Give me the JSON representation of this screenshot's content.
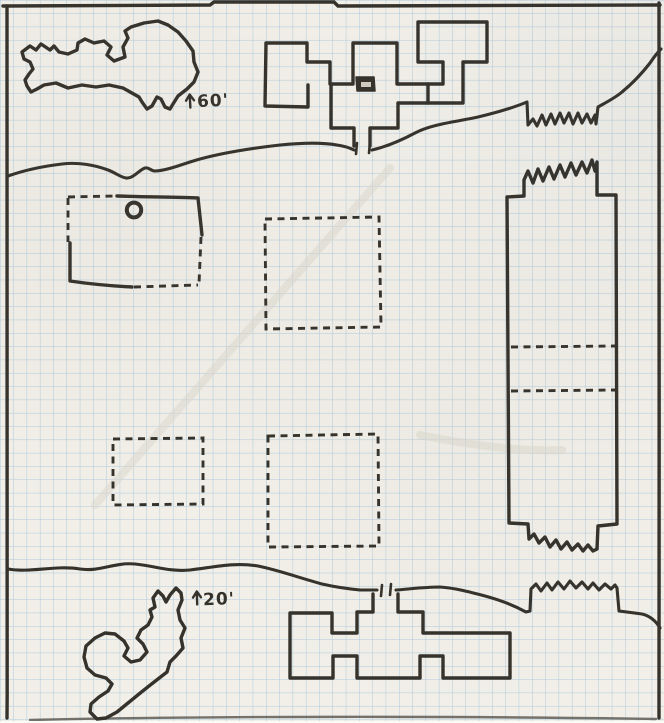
{
  "palette": {
    "paper": "#f1efe8",
    "grid": "#a3c3da",
    "ink": "#35322c",
    "ink-soft": "#55524b",
    "crease": "#dcd8cd"
  },
  "grid": {
    "cell_px": 13.3
  },
  "annotations": {
    "upper": {
      "label": "60'",
      "arrow_d": "M 190,107 L 190,95 M 186,100 L 190,94 L 194,100"
    },
    "lower": {
      "label": "20'",
      "arrow_d": "M 197,604 L 197,592 M 193,597 L 197,591 L 201,597"
    }
  },
  "features": {
    "border_top": {
      "d": "M 3,6 L 210,5 L 214,2 L 334,2 L 338,6 L 660,5"
    },
    "border_left": {
      "d": "M 7,6 C 6,200 9,460 7,718"
    },
    "border_right": {
      "d": "M 659,3 C 661,240 658,480 659,718"
    },
    "border_bottom": {
      "d": "M 30,720 C 200,716 460,716 656,719"
    },
    "cave_northwest": {
      "d": "M 22,52 L 30,46 L 36,50 L 41,44 L 50,50 L 54,46 L 59,52 L 68,54 L 77,50 L 78,43 L 85,39 L 94,43 L 104,41 L 111,47 L 107,55 L 114,61 L 125,57 L 123,47 L 128,38 L 125,31 L 131,27 L 144,23 L 158,21 L 168,25 L 178,32 L 186,41 L 193,51 L 194,62 L 198,72 L 194,82 L 187,89 L 178,96 L 173,104 L 170,109 L 165,107 L 161,99 L 157,97 L 152,106 L 147,109 L 142,102 L 139,97 L 123,88 L 109,85 L 96,87 L 82,85 L 68,88 L 56,83 L 44,85 L 37,89 L 31,92 L 27,86 L 25,80 L 29,74 L 33,69 L 30,62 L 24,59 Z"
    },
    "north_complex_west": {
      "d": "M 266,43 L 307,43 L 307,62 L 330,62 L 330,84 L 353,84 L 353,43 L 397,43 L 397,84 L 428,84 L 428,103 L 398,103 L 398,128 L 370,128 L 370,146 M 266,43 L 265,106 L 308,107 L 308,85 M 331,84 L 331,128 L 354,128 L 354,146"
    },
    "north_complex_east": {
      "d": "M 418,22 L 487,22 L 487,62 L 463,62 L 463,103 L 428,103 M 418,22 L 418,62 L 443,62 L 443,84 L 428,84"
    },
    "north_door_block": {
      "d": "M 356,77 L 374,77 L 375,91 L 357,91 Z"
    },
    "north_door_slot": {
      "d": "M 361,82 L 371,82 L 371,87 L 361,87 Z"
    },
    "north_door_ticks": {
      "d": "M 357,143 L 356,154 M 370,142 L 369,153"
    },
    "cliff_upper": {
      "d": "M 8,176 C 25,170 45,166 62,164 C 78,162 95,165 108,170 C 116,173 120,177 126,178 C 133,179 139,170 145,168 C 149,167 151,171 155,171 C 163,171 175,167 190,162 C 215,154 245,149 280,145 C 300,143 320,142 337,145 C 344,146 350,148 354,150 M 372,150 C 385,147 400,141 415,133 C 432,124 455,122 478,117 C 495,113 515,107 527,102 L 528,125 L 533,119 L 537,126 L 542,115 L 546,125 L 551,114 L 555,124 L 560,113 L 564,123 L 569,113 L 573,124 L 578,113 L 582,123 L 587,114 L 591,123 L 595,115 L 596,124 L 598,107 C 605,103 615,98 622,92 C 633,83 643,72 650,63 C 654,57 658,52 661,49"
    },
    "west_room_solid": {
      "d": "M 117,196 C 145,197 175,197 198,198 L 202,235 M 70,243 L 70,281 C 90,284 112,286 132,287"
    },
    "west_room_dashed": {
      "d": "M 68,197 L 115,196 M 68,198 L 68,242 M 134,287 L 198,285 M 201,237 L 199,284"
    },
    "west_room_pillar": {
      "d": "M 126.8,210 a 7.2,7.4 0 1 0 14.4,0 a 7.2,7.4 0 1 0 -14.4,0"
    },
    "pit_upper_middle": {
      "d": "M 265,219 L 379,217 L 381,327 L 266,329 Z"
    },
    "pit_lower_left": {
      "d": "M 113,439 L 203,438 L 203,504 L 113,505 Z"
    },
    "pit_lower_middle": {
      "d": "M 268,436 L 378,434 L 379,546 L 268,547 Z"
    },
    "east_hall": {
      "d": "M 507,197 L 524,196 L 524,180 L 528,171 L 533,183 L 538,169 L 543,181 L 549,167 L 554,179 L 560,165 L 565,177 L 571,163 L 576,175 L 582,162 L 587,173 L 592,160 L 595,171 L 597,162 L 597,195 L 616,195 L 617,524 L 598,526 L 597,549 L 593,551 L 588,545 L 583,551 L 578,544 L 572,550 L 567,542 L 561,549 L 556,540 L 550,547 L 545,537 L 539,543 L 534,534 L 529,539 L 528,524 L 509,523 Z"
    },
    "east_hall_dashes": {
      "d": "M 511,347 L 615,346 M 511,391 L 615,390"
    },
    "cliff_lower": {
      "d": "M 8,569 C 30,573 55,565 80,569 C 100,572 115,562 135,564 C 155,566 170,572 190,570 C 215,567 235,562 258,566 C 278,570 300,578 322,584 C 335,587 350,589 360,590 L 377,590 M 396,590 C 410,589 425,587 440,587 C 455,588 470,592 485,596 C 500,600 515,606 526,612 L 530,611 L 531,589 L 536,584 L 541,591 L 547,583 L 552,590 L 558,582 L 564,589 L 570,581 L 576,588 L 582,582 L 588,589 L 593,583 L 599,590 L 605,584 L 611,589 L 615,585 L 617,588 L 619,611 L 642,614 C 650,616 656,621 660,628"
    },
    "south_door_ticks": {
      "d": "M 382,585 L 381,596 M 391,584 L 390,595"
    },
    "south_complex": {
      "d": "M 373,594 L 373,612 L 357,612 L 357,633 L 332,633 L 332,613 L 290,613 L 290,678 L 333,678 L 333,656 L 357,656 L 357,678 L 420,678 L 420,656 L 443,656 L 443,678 L 510,678 L 510,633 L 423,633 L 423,612 L 398,612 L 398,594"
    },
    "cave_southwest": {
      "d": "M 155,607 L 153,598 L 158,591 L 163,596 L 166,602 L 170,595 L 176,588 L 181,593 L 182,600 L 178,610 L 180,620 L 185,628 L 181,638 L 183,648 L 176,656 L 170,662 L 167,672 L 158,679 L 149,686 L 139,694 L 128,703 L 117,712 L 106,718 L 97,719 L 90,712 L 91,704 L 99,697 L 108,691 L 112,684 L 106,678 L 95,675 L 87,668 L 84,657 L 86,646 L 95,638 L 105,633 L 115,634 L 124,641 L 128,648 L 124,656 L 131,662 L 140,660 L 147,652 L 143,644 L 137,638 L 141,630 L 148,625 L 152,617 L 150,610 Z"
    },
    "crease_1": {
      "d": "M 95,505 L 390,168"
    },
    "crease_2": {
      "d": "M 420,435 C 470,445 520,452 562,450"
    }
  }
}
